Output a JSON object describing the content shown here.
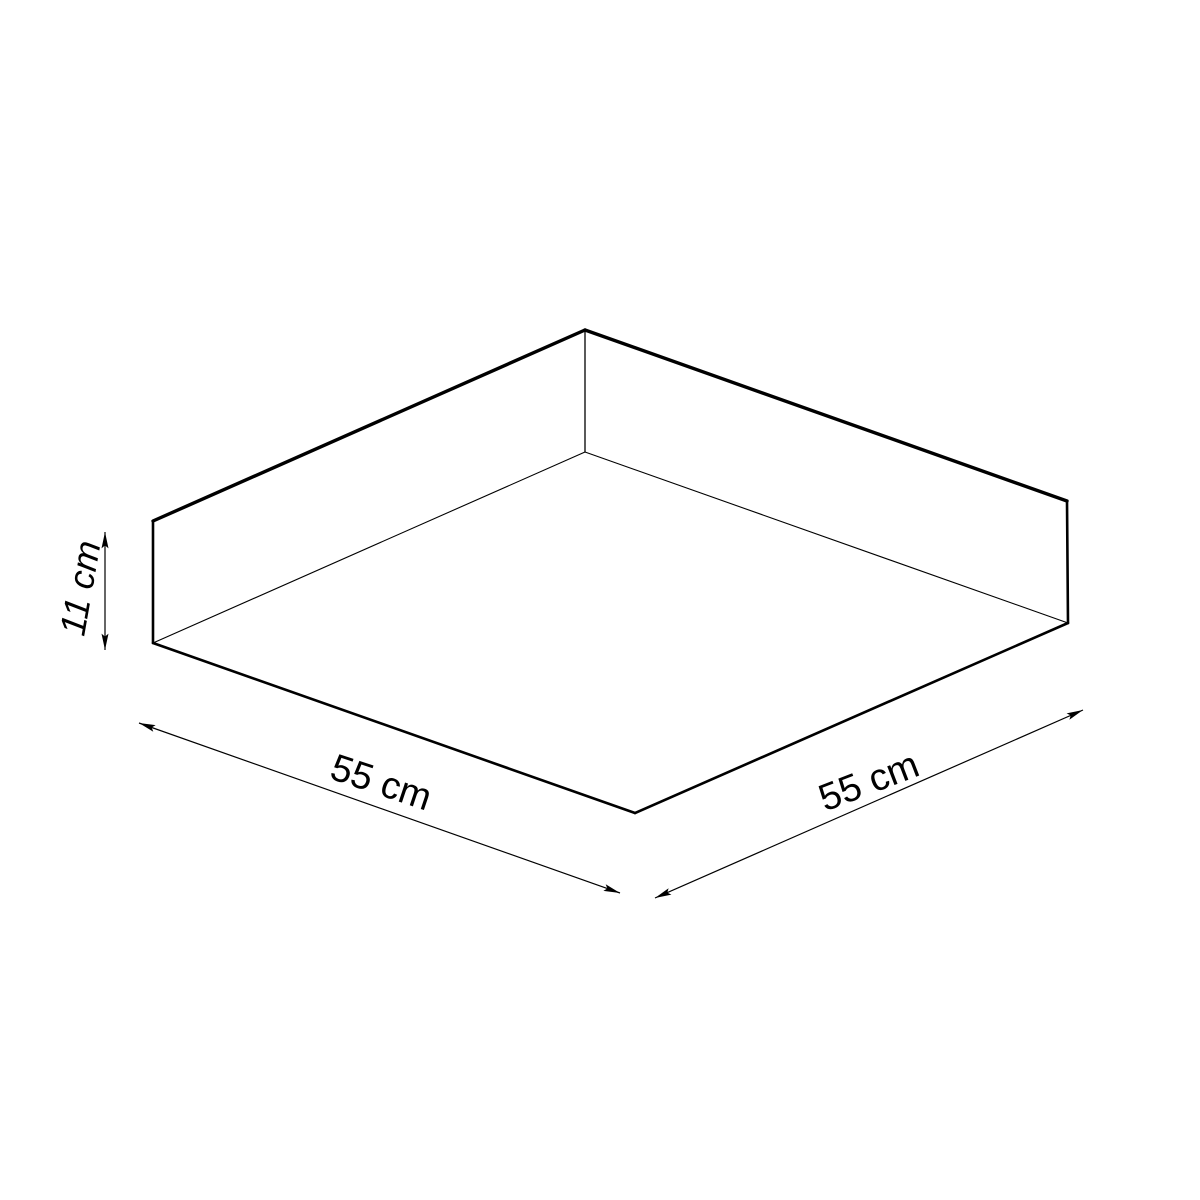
{
  "diagram": {
    "type": "isometric-dimension-drawing",
    "background_color": "#ffffff",
    "line_color": "#000000",
    "labels": {
      "height": "11 cm",
      "width_left": "55 cm",
      "width_right": "55 cm"
    }
  }
}
